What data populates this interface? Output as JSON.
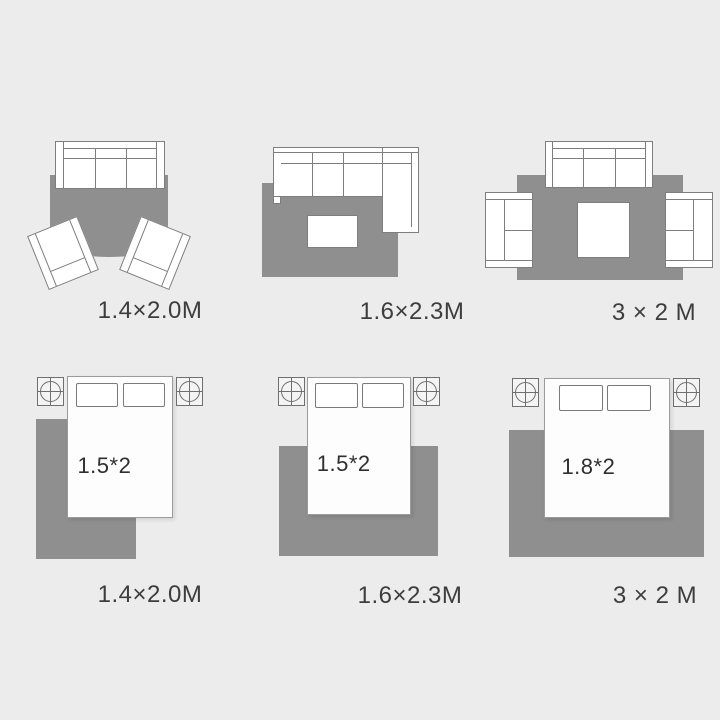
{
  "scene": {
    "background_color": "#ececec",
    "rug_color": "#8f8f8f",
    "furniture_line_color": "#7e7e7e",
    "label_color": "#3d3d3d"
  },
  "living_layouts": [
    {
      "name": "sofa-with-two-armchairs",
      "size_label": "1.4×2.0M"
    },
    {
      "name": "sectional-sofa-with-coffee-table",
      "size_label": "1.6×2.3M"
    },
    {
      "name": "sofa-set-three-pieces",
      "size_label": "3 × 2 M"
    }
  ],
  "bedroom_layouts": [
    {
      "name": "bed-offset-on-rug",
      "bed_label": "1.5*2",
      "size_label": "1.4×2.0M"
    },
    {
      "name": "bed-centered-on-rug",
      "bed_label": "1.5*2",
      "size_label": "1.6×2.3M"
    },
    {
      "name": "wide-bed-on-large-rug",
      "bed_label": "1.8*2",
      "size_label": "3 × 2 M"
    }
  ]
}
